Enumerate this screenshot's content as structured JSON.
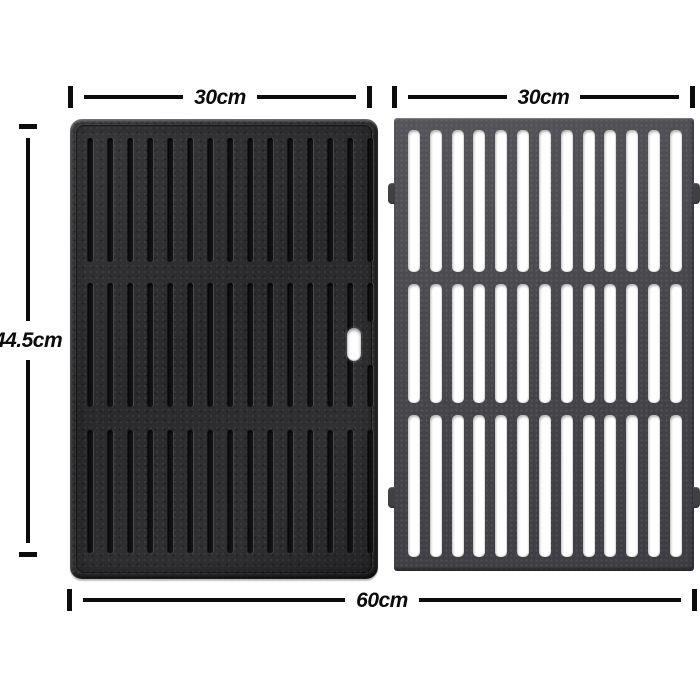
{
  "figure": {
    "kind": "product-dimension-diagram",
    "left_plate": "reversible cast-iron griddle plate",
    "right_plate": "cast-iron grill grate with bars",
    "groove_bands": 3,
    "grooves_per_band": 15,
    "plain_grooves_band2": 14,
    "grate_sections": 3,
    "slots_per_section": 13
  },
  "dimensions": {
    "left_plate_width": "30cm",
    "right_plate_width": "30cm",
    "height": "44.5cm",
    "total_width": "60cm"
  },
  "colors": {
    "background": "#ffffff",
    "dimension_ink": "#0c0c0c",
    "griddle_body": "#2c2c2e",
    "grate_body": "#48484c",
    "slot_openings": "#ffffff"
  }
}
